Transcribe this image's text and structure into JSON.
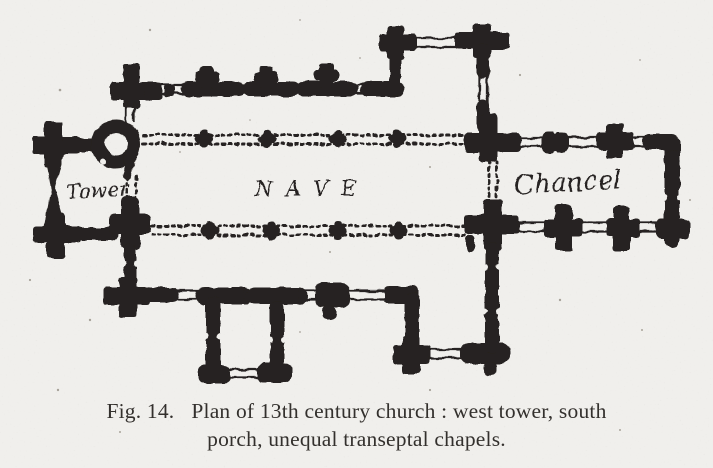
{
  "figure": {
    "labels": {
      "tower": "Tower",
      "nave": "NAVE",
      "chancel": "Chancel"
    },
    "caption": {
      "fig_label": "Fig. 14.",
      "line1": "Plan of 13th century church :  west tower, south",
      "line2": "porch, unequal transeptal chapels."
    },
    "colors": {
      "paper": "#f0efec",
      "ink": "#262220",
      "caption_text": "#33302d"
    }
  }
}
